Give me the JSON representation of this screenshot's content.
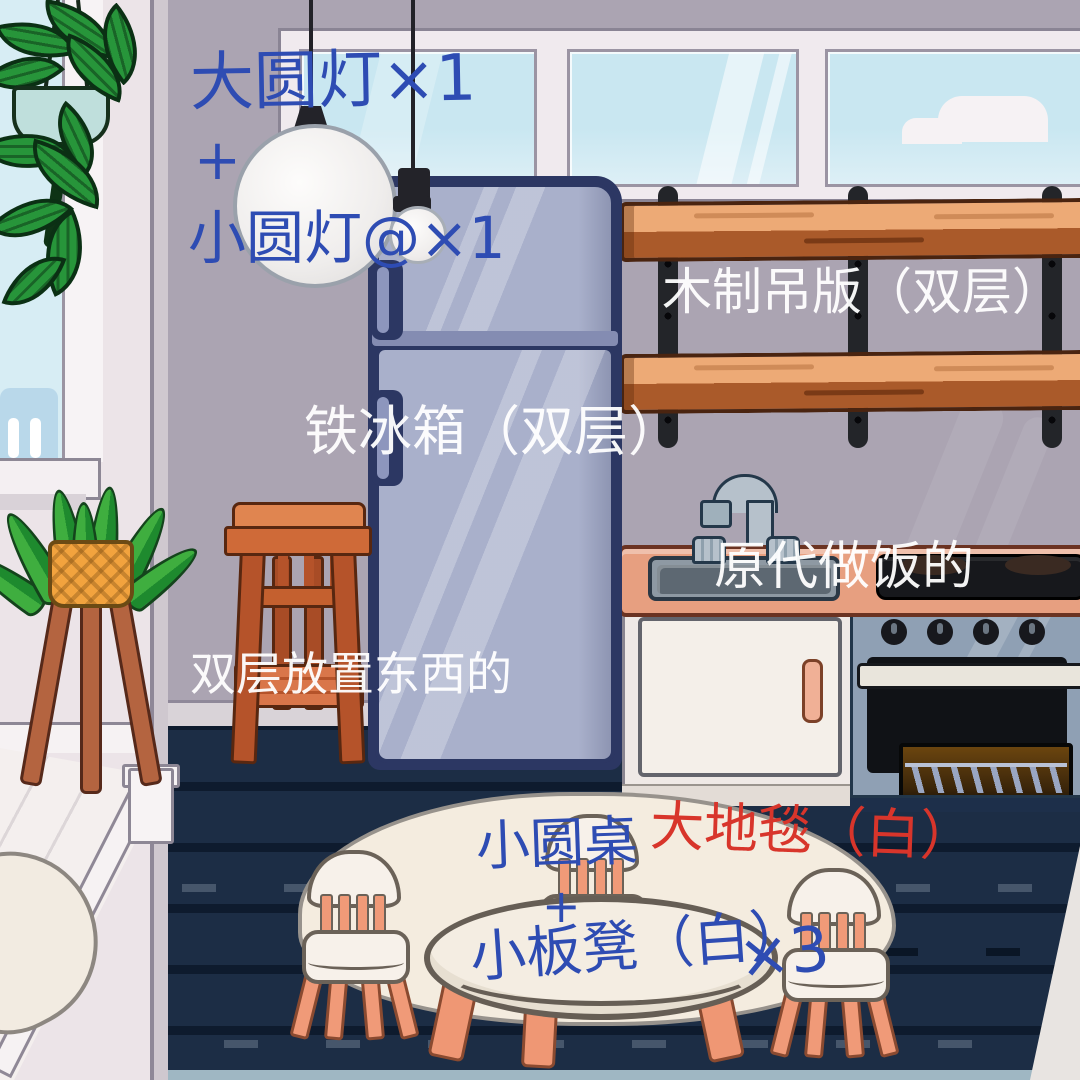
{
  "annotations": {
    "big_lamp": {
      "text": "大圆灯×1",
      "color": "#2e4cb3"
    },
    "plus_top": {
      "text": "+",
      "color": "#2e4cb3"
    },
    "small_lamp": {
      "text": "小圆灯@×1",
      "color": "#2e4cb3"
    },
    "shelf": {
      "text": "木制吊版（双层）",
      "color": "#ffffff"
    },
    "fridge": {
      "text": "铁冰箱（双层）",
      "color": "#ffffff"
    },
    "cooker": {
      "text": "原代做饭的",
      "color": "#ffffff"
    },
    "stool": {
      "text": "双层放置东西的",
      "color": "#ffffff"
    },
    "table": {
      "text": "小圆桌",
      "color": "#2e4cb3"
    },
    "rug": {
      "text": "大地毯（白）",
      "color": "#d8352b"
    },
    "plus_bottom": {
      "text": "+",
      "color": "#2e4cb3"
    },
    "stools_white": {
      "text": "小板凳（白）",
      "color": "#2e4cb3"
    },
    "stools_count": {
      "text": "×3",
      "color": "#2e4cb3"
    }
  },
  "palette": {
    "annotation_blue": "#2e4cb3",
    "annotation_red": "#d8352b",
    "annotation_white": "#ffffff",
    "wall": "#aba4b2",
    "alcove_wall": "#ece4e8",
    "sky": "#c9e7f1",
    "fridge_body": "#a9b0cb",
    "fridge_outline": "#2c3763",
    "rug_navy": "#1c2d45",
    "shelf_wood_top": "#edaa76",
    "shelf_wood_edge": "#aa5a2a",
    "counter_top": "#e79f80",
    "stool_wood": "#c4602f",
    "chair_white": "#f7f1ea",
    "chair_salmon": "#f09a78",
    "white_rug": "#f4ecdf",
    "oven_front": "#8fa0b4",
    "plant_green": "#3fae3f",
    "pot_orange": "#f2a33e"
  }
}
